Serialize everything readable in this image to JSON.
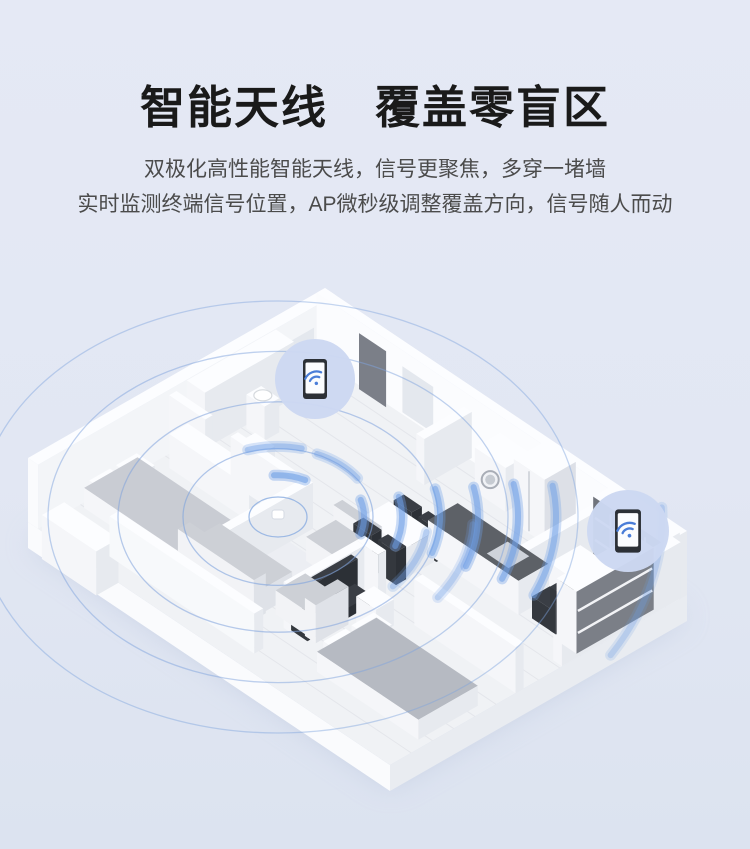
{
  "page": {
    "background_color": "#e2e7f3"
  },
  "hero": {
    "title": "智能天线　覆盖零盲区",
    "subtitle_line1": "双极化高性能智能天线，信号更聚焦，多穿一堵墙",
    "subtitle_line2": "实时监测终端信号位置，AP微秒级调整覆盖方向，信号随人而动",
    "title_color": "#1a1a1a",
    "subtitle_color": "#4b4b4b"
  },
  "illustration": {
    "type": "isometric-apartment-wifi-coverage",
    "accent_color": "#6f9fe6",
    "ring_color": "#7fa3dd",
    "badge_fill": "#ccd8f2",
    "wifi_icon_color": "#4a7dd8",
    "device_badge_count": 2
  }
}
